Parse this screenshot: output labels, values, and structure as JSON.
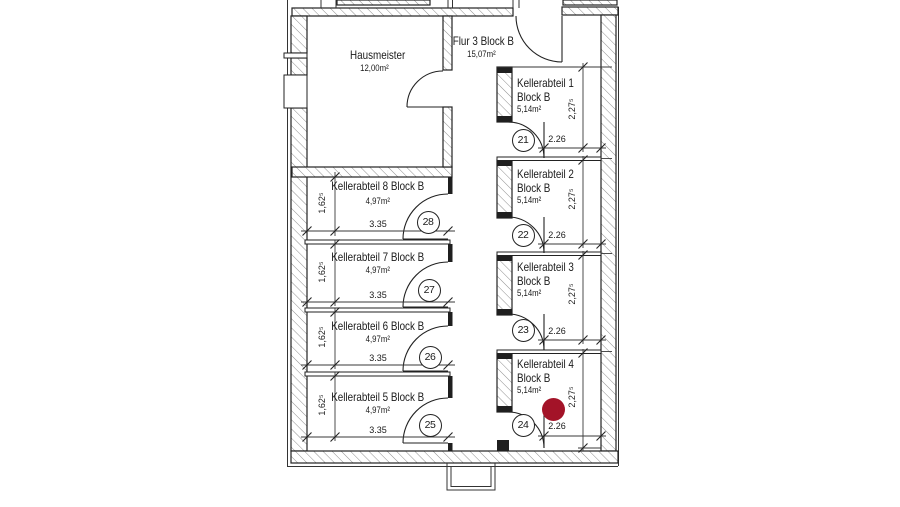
{
  "plan": {
    "hausmeister": {
      "name": "Hausmeister",
      "area": "12,00m²"
    },
    "flur": {
      "name": "Flur 3 Block B",
      "area": "15,07m²"
    },
    "kellerRight": [
      {
        "name": "Kellerabteil 1",
        "block": "Block B",
        "area": "5,14m²",
        "door_no": "21",
        "dim_w": "2.26",
        "dim_h": "2,27⁵"
      },
      {
        "name": "Kellerabteil 2",
        "block": "Block B",
        "area": "5,14m²",
        "door_no": "22",
        "dim_w": "2.26",
        "dim_h": "2,27⁵"
      },
      {
        "name": "Kellerabteil 3",
        "block": "Block B",
        "area": "5,14m²",
        "door_no": "23",
        "dim_w": "2.26",
        "dim_h": "2,27⁵"
      },
      {
        "name": "Kellerabteil 4",
        "block": "Block B",
        "area": "5,14m²",
        "door_no": "24",
        "dim_w": "2.26",
        "dim_h": "2,27⁵"
      }
    ],
    "kellerLeft": [
      {
        "name": "Kellerabteil 8 Block B",
        "area": "4,97m²",
        "door_no": "28",
        "dim_w": "3.35",
        "dim_h": "1,62⁵"
      },
      {
        "name": "Kellerabteil 7 Block B",
        "area": "4,97m²",
        "door_no": "27",
        "dim_w": "3.35",
        "dim_h": "1,62⁵"
      },
      {
        "name": "Kellerabteil 6 Block B",
        "area": "4,97m²",
        "door_no": "26",
        "dim_w": "3.35",
        "dim_h": "1,62⁵"
      },
      {
        "name": "Kellerabteil 5 Block B",
        "area": "4,97m²",
        "door_no": "25",
        "dim_w": "3.35",
        "dim_h": "1,62⁵"
      }
    ],
    "marker_color": "#A31328"
  }
}
